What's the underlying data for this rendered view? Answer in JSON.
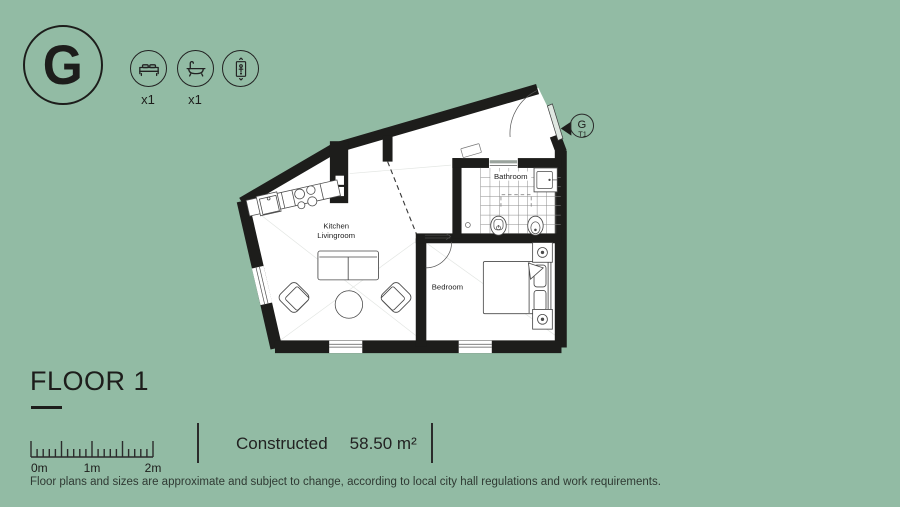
{
  "colors": {
    "background": "#92bba4",
    "ink": "#1d1d1b",
    "wall": "#1d1d1b",
    "furniture_line": "#4a4a4a",
    "tile_line": "#808080"
  },
  "header": {
    "block_letter": "G",
    "amenities": [
      {
        "icon": "bed-icon",
        "count": "x1"
      },
      {
        "icon": "bath-icon",
        "count": "x1"
      },
      {
        "icon": "elevator-icon",
        "count": ""
      }
    ]
  },
  "plan": {
    "rooms": {
      "kitchen_living_line1": "Kitchen",
      "kitchen_living_line2": "Livingroom",
      "bedroom": "Bedroom",
      "bathroom": "Bathroom"
    },
    "entrance_badge": {
      "letter": "G",
      "unit": "T1"
    }
  },
  "footer": {
    "floor_label": "FLOOR 1",
    "scale": {
      "labels": [
        "0m",
        "1m",
        "2m"
      ]
    },
    "constructed_label": "Constructed",
    "constructed_value": "58.50 m²",
    "disclaimer": "Floor plans and sizes are approximate and subject to change, according to local city hall regulations and work requirements."
  }
}
